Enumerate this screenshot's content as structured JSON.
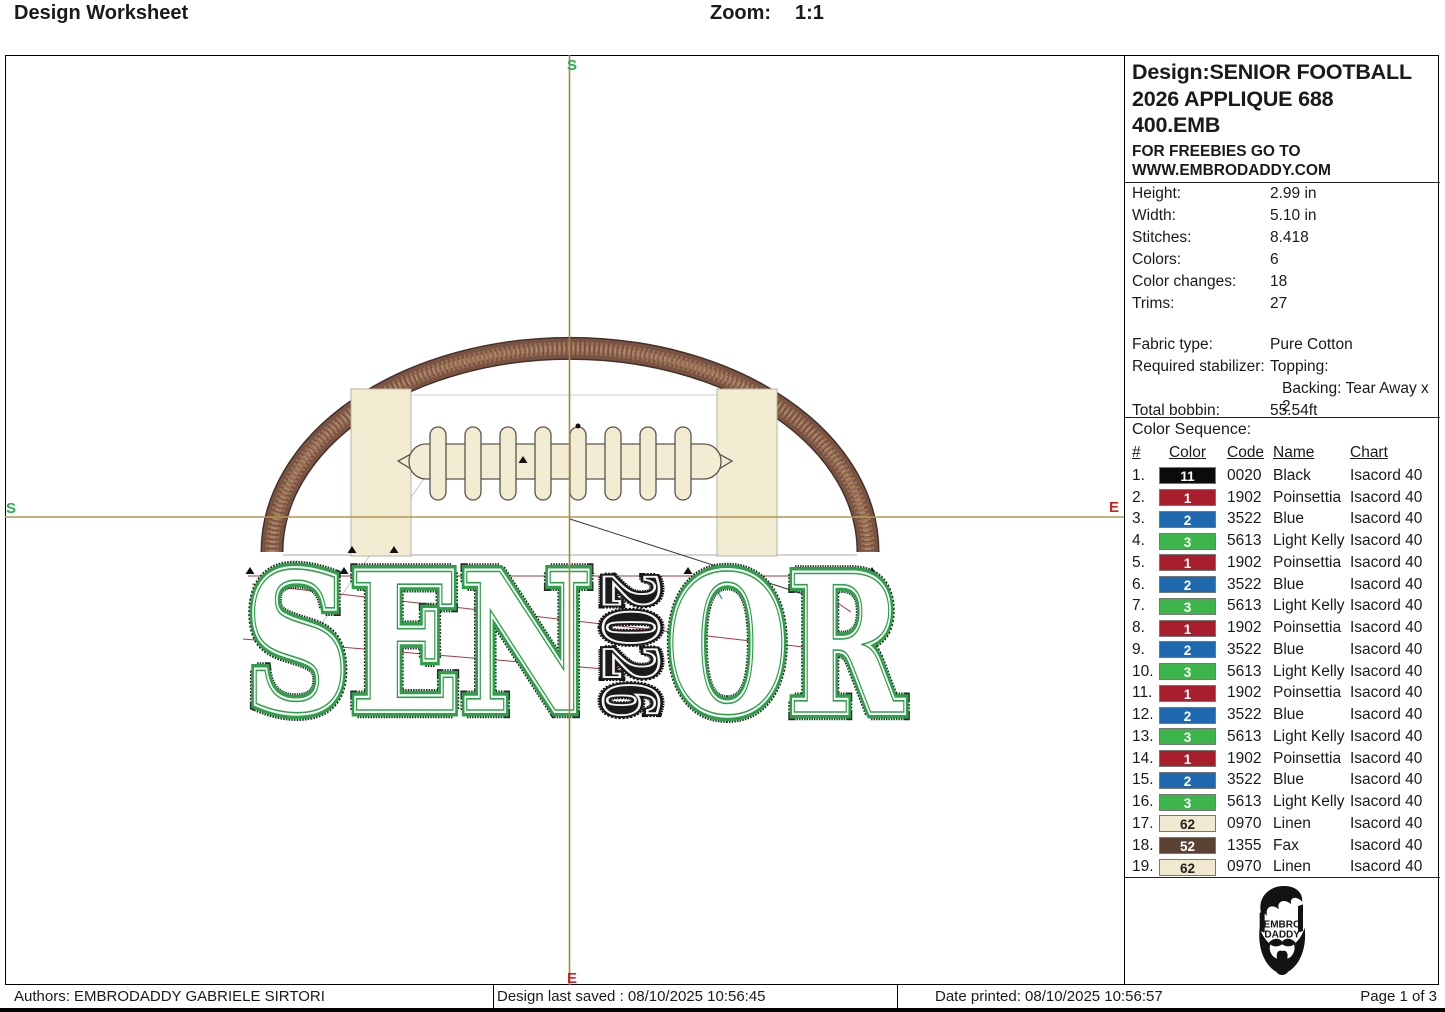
{
  "header": {
    "title": "Design Worksheet",
    "zoom_label": "Zoom:",
    "zoom_value": "1:1"
  },
  "panel": {
    "title_lines": [
      "Design:SENIOR FOOTBALL",
      "2026 APPLIQUE 688",
      "400.EMB"
    ],
    "freebies_lines": [
      "FOR FREEBIES GO TO",
      "WWW.EMBRODADDY.COM"
    ],
    "specs": [
      {
        "label": "Height:",
        "value": "2.99 in"
      },
      {
        "label": "Width:",
        "value": "5.10 in"
      },
      {
        "label": "Stitches:",
        "value": "8.418"
      },
      {
        "label": "Colors:",
        "value": "6"
      },
      {
        "label": "Color changes:",
        "value": "18"
      },
      {
        "label": "Trims:",
        "value": "27"
      }
    ],
    "fabric": [
      {
        "label": "Fabric type:",
        "value": "Pure Cotton"
      },
      {
        "label": "Required stabilizer:",
        "value": "Topping:"
      },
      {
        "label": "",
        "value": "Backing: Tear Away x 2"
      },
      {
        "label": "Total bobbin:",
        "value": "55.54ft"
      }
    ],
    "color_sequence_title": "Color Sequence:",
    "table_headers": [
      "#",
      "Color",
      "Code",
      "Name",
      "Chart"
    ],
    "rows": [
      {
        "num": "1.",
        "swatch": "#0b0b0b",
        "swatch_label": "11",
        "label_color": "#ffffff",
        "code": "0020",
        "name": "Black",
        "chart": "Isacord 40"
      },
      {
        "num": "2.",
        "swatch": "#a81e2c",
        "swatch_label": "1",
        "label_color": "#ffffff",
        "code": "1902",
        "name": "Poinsettia",
        "chart": "Isacord 40"
      },
      {
        "num": "3.",
        "swatch": "#1e69b0",
        "swatch_label": "2",
        "label_color": "#ffffff",
        "code": "3522",
        "name": "Blue",
        "chart": "Isacord 40"
      },
      {
        "num": "4.",
        "swatch": "#3cb54a",
        "swatch_label": "3",
        "label_color": "#ffffff",
        "code": "5613",
        "name": "Light Kelly",
        "chart": "Isacord 40"
      },
      {
        "num": "5.",
        "swatch": "#a81e2c",
        "swatch_label": "1",
        "label_color": "#ffffff",
        "code": "1902",
        "name": "Poinsettia",
        "chart": "Isacord 40"
      },
      {
        "num": "6.",
        "swatch": "#1e69b0",
        "swatch_label": "2",
        "label_color": "#ffffff",
        "code": "3522",
        "name": "Blue",
        "chart": "Isacord 40"
      },
      {
        "num": "7.",
        "swatch": "#3cb54a",
        "swatch_label": "3",
        "label_color": "#ffffff",
        "code": "5613",
        "name": "Light Kelly",
        "chart": "Isacord 40"
      },
      {
        "num": "8.",
        "swatch": "#a81e2c",
        "swatch_label": "1",
        "label_color": "#ffffff",
        "code": "1902",
        "name": "Poinsettia",
        "chart": "Isacord 40"
      },
      {
        "num": "9.",
        "swatch": "#1e69b0",
        "swatch_label": "2",
        "label_color": "#ffffff",
        "code": "3522",
        "name": "Blue",
        "chart": "Isacord 40"
      },
      {
        "num": "10.",
        "swatch": "#3cb54a",
        "swatch_label": "3",
        "label_color": "#ffffff",
        "code": "5613",
        "name": "Light Kelly",
        "chart": "Isacord 40"
      },
      {
        "num": "11.",
        "swatch": "#a81e2c",
        "swatch_label": "1",
        "label_color": "#ffffff",
        "code": "1902",
        "name": "Poinsettia",
        "chart": "Isacord 40"
      },
      {
        "num": "12.",
        "swatch": "#1e69b0",
        "swatch_label": "2",
        "label_color": "#ffffff",
        "code": "3522",
        "name": "Blue",
        "chart": "Isacord 40"
      },
      {
        "num": "13.",
        "swatch": "#3cb54a",
        "swatch_label": "3",
        "label_color": "#ffffff",
        "code": "5613",
        "name": "Light Kelly",
        "chart": "Isacord 40"
      },
      {
        "num": "14.",
        "swatch": "#a81e2c",
        "swatch_label": "1",
        "label_color": "#ffffff",
        "code": "1902",
        "name": "Poinsettia",
        "chart": "Isacord 40"
      },
      {
        "num": "15.",
        "swatch": "#1e69b0",
        "swatch_label": "2",
        "label_color": "#ffffff",
        "code": "3522",
        "name": "Blue",
        "chart": "Isacord 40"
      },
      {
        "num": "16.",
        "swatch": "#3cb54a",
        "swatch_label": "3",
        "label_color": "#ffffff",
        "code": "5613",
        "name": "Light Kelly",
        "chart": "Isacord 40"
      },
      {
        "num": "17.",
        "swatch": "#f0e9cf",
        "swatch_label": "62",
        "label_color": "#222222",
        "code": "0970",
        "name": "Linen",
        "chart": "Isacord 40"
      },
      {
        "num": "18.",
        "swatch": "#5a4233",
        "swatch_label": "52",
        "label_color": "#ffffff",
        "code": "1355",
        "name": "Fax",
        "chart": "Isacord 40"
      },
      {
        "num": "19.",
        "swatch": "#f0e9cf",
        "swatch_label": "62",
        "label_color": "#222222",
        "code": "0970",
        "name": "Linen",
        "chart": "Isacord 40"
      }
    ],
    "logo_text": [
      "EMBRO",
      "DADDY"
    ]
  },
  "canvas": {
    "design_text_left": "SEN",
    "design_text_year": "2026",
    "design_text_right": "OR",
    "markers": {
      "top": "S",
      "left": "S",
      "right": "E",
      "bottom": "E"
    },
    "colors": {
      "letter_green": "#2fa04a",
      "year_black": "#1a1a1a",
      "football_brown": "#7a5443",
      "linen": "#f2ecd3",
      "crosshair": "#a5893c",
      "marker_green": "#22b14c",
      "marker_red": "#cc2222"
    }
  },
  "footer": {
    "authors": "Authors: EMBRODADDY GABRIELE SIRTORI",
    "saved": "Design last saved : 08/10/2025 10:56:45",
    "printed": "Date printed: 08/10/2025 10:56:57",
    "page": "Page 1 of 3"
  }
}
